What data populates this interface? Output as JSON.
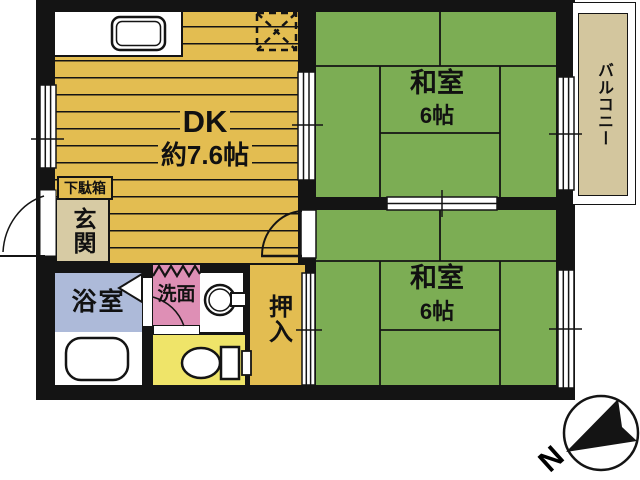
{
  "title": "apartment-floor-plan",
  "colors": {
    "wall": "#141414",
    "dk_yellow": "#E3BD51",
    "tatami_green": "#7CAD54",
    "balcony_tan": "#D3C69E",
    "genkan_tan": "#D7CBA4",
    "bath_blue": "#ADBAD9",
    "washroom_pink": "#DE8FB5",
    "toilet_yellow": "#EFE469"
  },
  "rooms": {
    "dk": {
      "label": "DK",
      "size": "約7.6帖"
    },
    "washitsu_upper": {
      "label": "和室",
      "size": "6帖"
    },
    "washitsu_lower": {
      "label": "和室",
      "size": "6帖"
    },
    "balcony": {
      "label": "バルコニー"
    },
    "genkan": {
      "label": "玄関"
    },
    "getabako": {
      "label": "下駄箱"
    },
    "bathroom": {
      "label": "浴室"
    },
    "washroom": {
      "label": "洗面"
    },
    "oshiire": {
      "label": "押入"
    }
  },
  "compass": {
    "label": "N"
  },
  "icons": {
    "kitchen_sink": "kitchen-sink-icon",
    "refrigerator_space": "refrigerator-space-icon",
    "bathtub": "bathtub-icon",
    "toilet": "toilet-icon",
    "washing_machine": "washing-machine-icon",
    "north_arrow": "north-arrow-icon"
  }
}
